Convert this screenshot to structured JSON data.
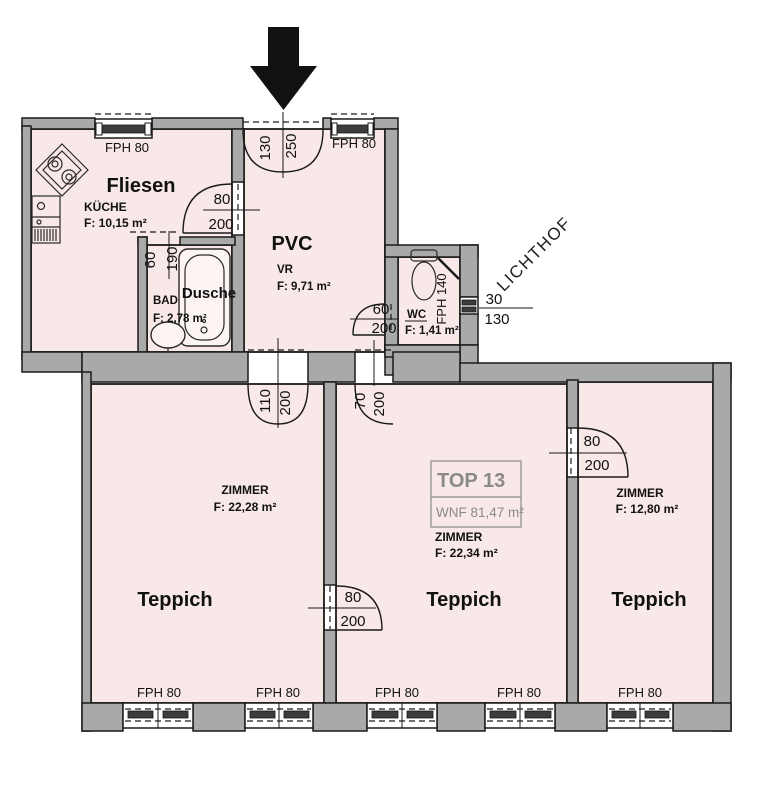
{
  "colors": {
    "room_fill": "#f8e8e8",
    "wall": "#a9a9a9",
    "line": "#1a1a1a",
    "unit_box_text": "#8a8a8a"
  },
  "labels": {
    "lichthof": "LICHTHOF"
  },
  "unit_box": {
    "top": "TOP 13",
    "wnf": "WNF  81,47 m²"
  },
  "rooms": {
    "kueche": {
      "floor": "Fliesen",
      "name": "KÜCHE",
      "area": "F: 10,15 m²",
      "window": "FPH 80"
    },
    "vr": {
      "floor": "PVC",
      "name": "VR",
      "area": "F: 9,71 m²",
      "window": "FPH 80"
    },
    "bad": {
      "name": "BAD",
      "area": "F: 2,78 m²",
      "fixture": "Dusche"
    },
    "wc": {
      "name": "WC",
      "area": "F: 1,41 m²",
      "window": "FPH 140"
    },
    "zimmer_left": {
      "name": "ZIMMER",
      "area": "F: 22,28 m²",
      "floor": "Teppich"
    },
    "zimmer_mid": {
      "name": "ZIMMER",
      "area": "F: 22,34 m²",
      "floor": "Teppich"
    },
    "zimmer_right": {
      "name": "ZIMMER",
      "area": "F: 12,80 m²",
      "floor": "Teppich"
    }
  },
  "bottom_windows": [
    "FPH 80",
    "FPH 80",
    "FPH 80",
    "FPH 80",
    "FPH 80"
  ],
  "dims": {
    "entry": [
      "130",
      "250"
    ],
    "kueche_door": [
      "80",
      "200"
    ],
    "bad_door": [
      "60",
      "190"
    ],
    "wc_door": [
      "60",
      "200"
    ],
    "wc_window": [
      "30",
      "130"
    ],
    "vr_left_door": [
      "110",
      "200"
    ],
    "vr_mid_door": [
      "70",
      "200"
    ],
    "left_mid_door": [
      "80",
      "200"
    ],
    "mid_right_door": [
      "80",
      "200"
    ]
  }
}
